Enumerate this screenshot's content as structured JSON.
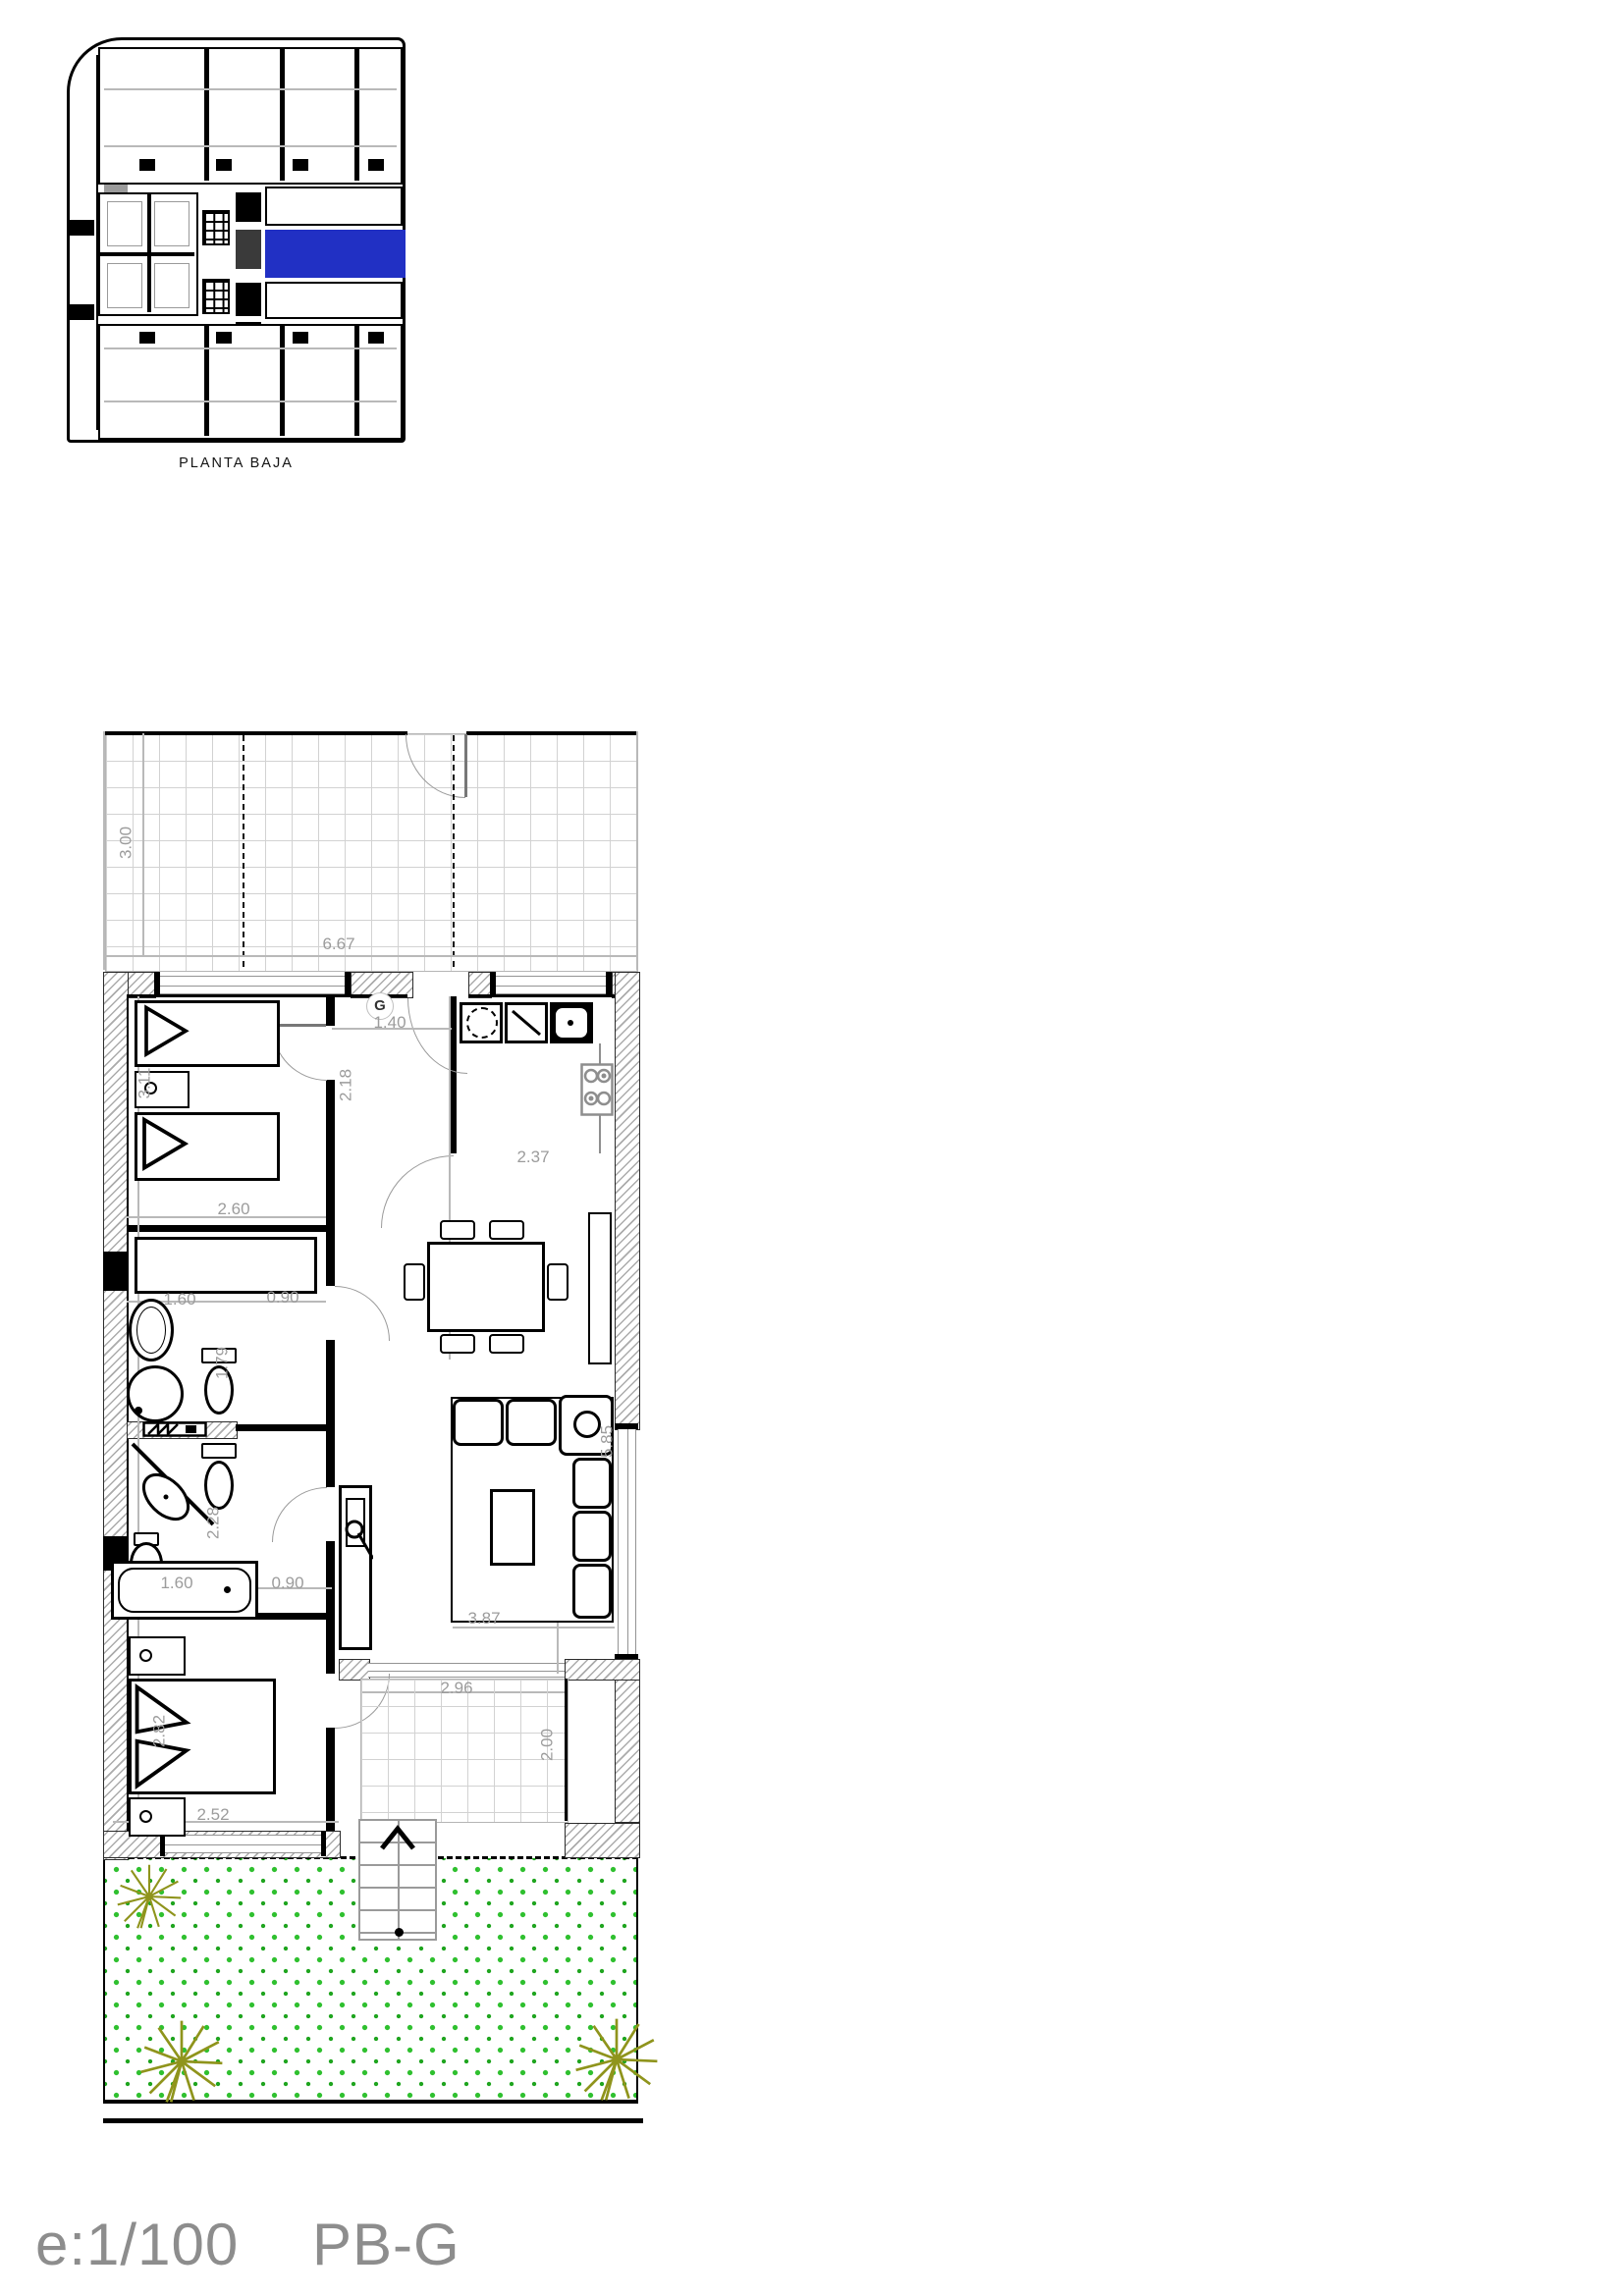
{
  "overview": {
    "title": "PLANTA BAJA"
  },
  "footer": {
    "scale": "e:1/100",
    "unit_code": "PB-G"
  },
  "main_plan": {
    "ground_marker": "G",
    "dims": {
      "terrace_depth": "3.00",
      "terrace_width": "6.67",
      "entry_width": "1.40",
      "hall_depth": "2.18",
      "bedroom1_depth": "3.11",
      "bedroom1_width": "2.60",
      "kitchen_width": "2.37",
      "bath1_width": "1.60",
      "bath1_door": "0.90",
      "bath1_depth": "1.79",
      "bath2_depth": "2.28",
      "bathtub_length": "1.60",
      "bath2_door": "0.90",
      "bedroom2_width": "2.52",
      "bedroom2_depth": "2.82",
      "living_width": "3.87",
      "living_depth": "5.85",
      "terrace2_width": "2.96",
      "terrace2_depth": "2.00"
    }
  },
  "colors": {
    "highlight_blue": "#2130c4",
    "garden_green": "#2fc02f",
    "garden_green_dark": "#1fa51f",
    "plant_olive": "#8f941c",
    "dimension_gray": "#9c9c9c",
    "hatch_gray": "#ababab",
    "tile_gray": "#d2d2d2"
  }
}
